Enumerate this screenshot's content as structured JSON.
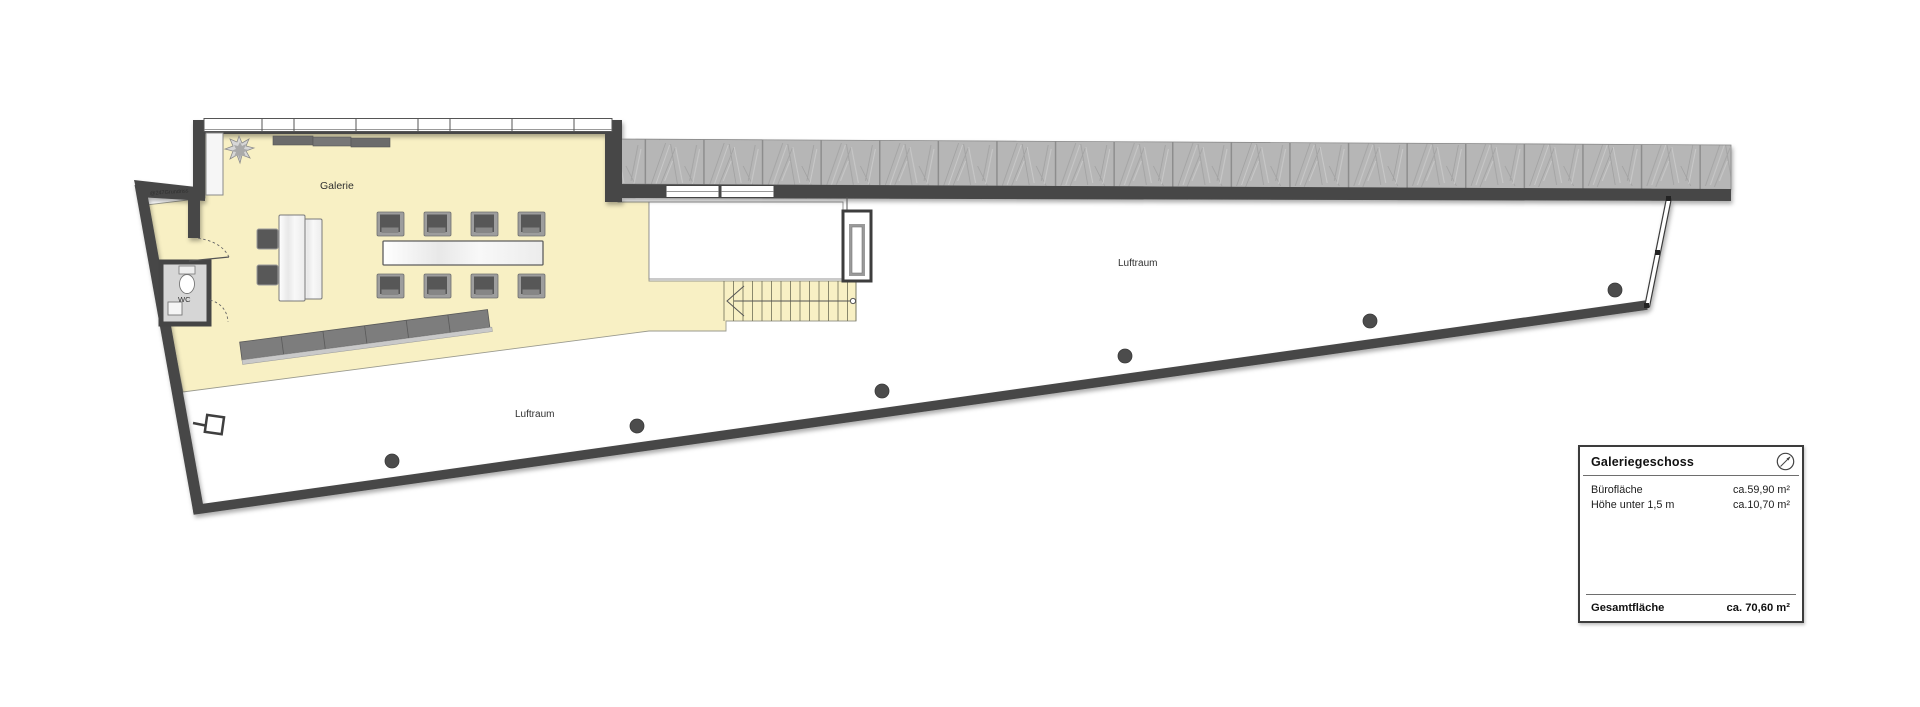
{
  "plan": {
    "room_labels": {
      "galerie": "Galerie",
      "wc": "WC",
      "luftraum_left": "Luftraum",
      "luftraum_right": "Luftraum"
    },
    "watermark": "@247Grundriss",
    "colors": {
      "floor_yellow": "#F8F0C4",
      "wall_dark": "#474747",
      "roof_gray": "#B6B6B6",
      "wc_floor": "#D6D6D6",
      "column_gray": "#4C4C4C",
      "furniture_dark": "#575757",
      "rail_light": "#C9C9C9"
    }
  },
  "legend": {
    "title": "Galeriegeschoss",
    "rows": [
      {
        "label": "Bürofläche",
        "value": "ca.59,90 m²"
      },
      {
        "label": "Höhe unter 1,5 m",
        "value": "ca.10,70 m²"
      }
    ],
    "total_label": "Gesamtfläche",
    "total_value": "ca. 70,60 m²"
  }
}
